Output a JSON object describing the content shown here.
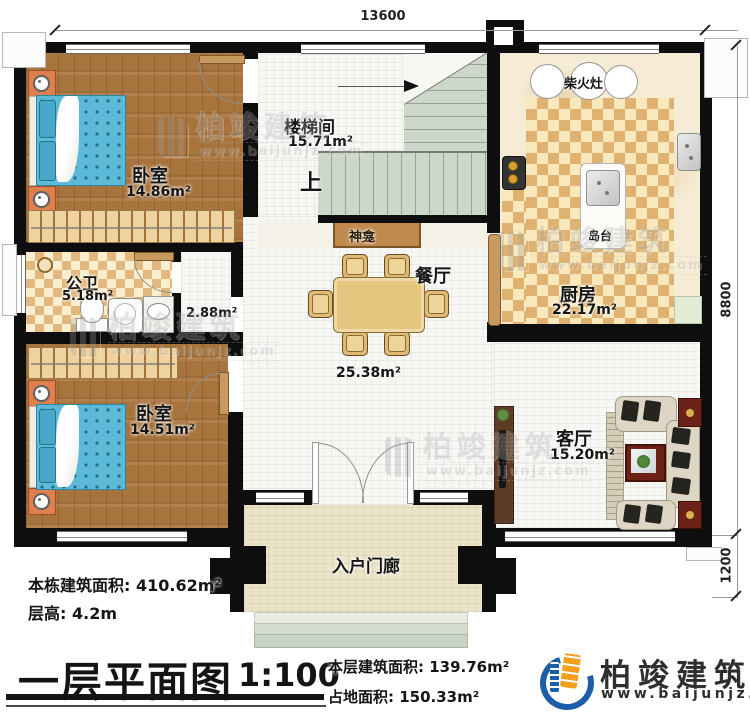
{
  "plan": {
    "rooms": {
      "bedroom1": {
        "name": "卧室",
        "area": "14.86m²"
      },
      "stairwell": {
        "name": "楼梯间",
        "area": "15.71m²",
        "up": "上"
      },
      "kitchen": {
        "name": "厨房",
        "area": "22.17m²",
        "stove": "柴火灶",
        "island": "岛台"
      },
      "bathroom": {
        "name": "公卫",
        "area": "5.18m²"
      },
      "hallway": {
        "area": "2.88m²"
      },
      "bedroom2": {
        "name": "卧室",
        "area": "14.51m²"
      },
      "dining": {
        "name": "餐厅",
        "area": "25.38m²",
        "shrine": "神龛"
      },
      "living": {
        "name": "客厅",
        "area": "15.20m²"
      },
      "porch": {
        "name": "入户门廊"
      }
    },
    "dimensions": {
      "top": "13600",
      "right_main": "8800",
      "right_porch": "1200"
    }
  },
  "info": {
    "building_area_label": "本栋建筑面积:",
    "building_area_value": "410.62m²",
    "floor_height_label": "层高:",
    "floor_height_value": "4.2m"
  },
  "titleblock": {
    "title": "一层平面图",
    "scale": "1:100",
    "floor_area_label": "本层建筑面积:",
    "floor_area_value": "139.76m²",
    "footprint_label": "占地面积:",
    "footprint_value": "150.33m²"
  },
  "brand": {
    "name": "柏竣建筑",
    "url": "www.baijunjz.com"
  },
  "watermark": {
    "name": "柏竣建筑",
    "url": "www.baijunjz.com"
  },
  "colors": {
    "wall": "#0e0e0e",
    "wood": "#a8743e",
    "bed_blue": "#5db9d8",
    "stair_green": "#cdd7ca",
    "brand_blue": "#1c5fa8",
    "brand_orange": "#f5a01c"
  }
}
